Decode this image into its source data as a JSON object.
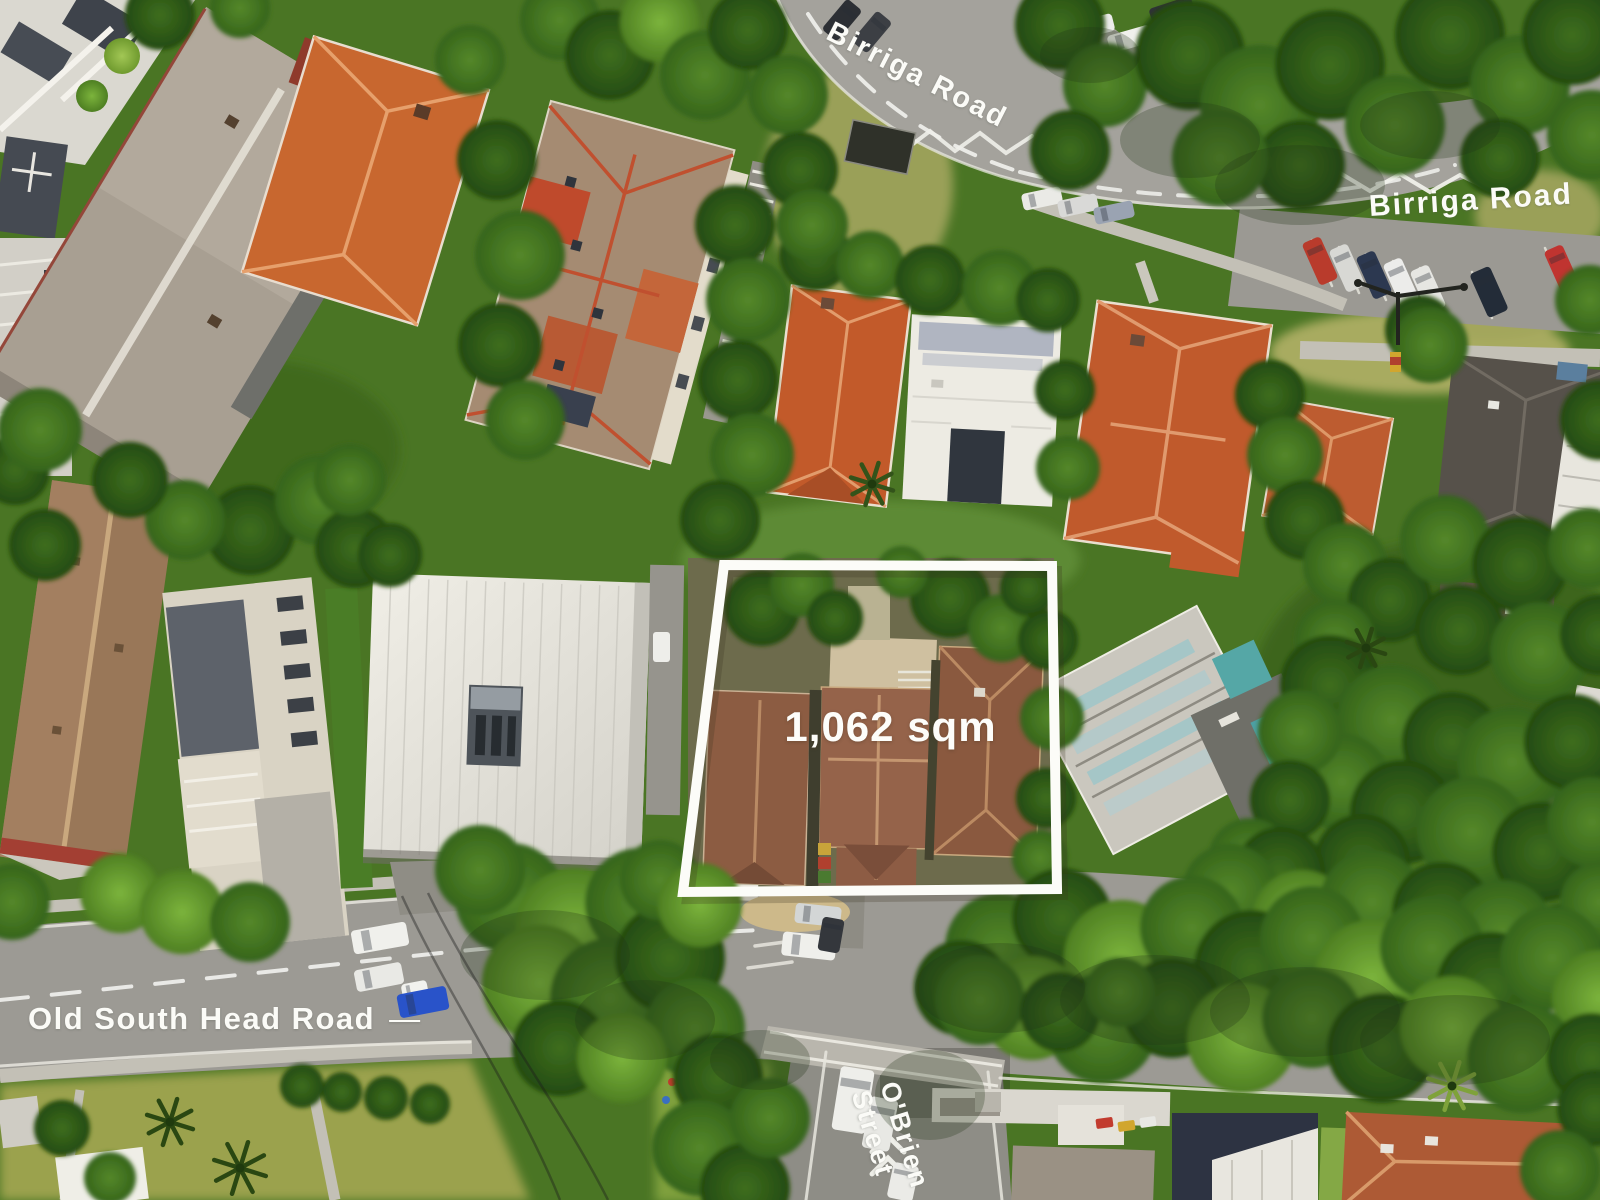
{
  "annotations": {
    "birriga_road_top": {
      "text": "Birriga Road"
    },
    "birriga_road_right": {
      "text": "Birriga Road"
    },
    "lot": {
      "area_label": "1,062 sqm",
      "outline_color": "#fcfcf8"
    },
    "old_south_head_road": {
      "text": "Old South Head Road",
      "dash": "—"
    },
    "obrien_street": {
      "line1": "O'Brien",
      "line2": "Street"
    }
  },
  "palette": {
    "label_text": "#fbfbf7",
    "lot_outline": "#fcfcf8",
    "road": "#a4a29c",
    "road_shaded": "#8e8d86",
    "tree_dark": "#2f5a17",
    "tree_mid": "#4a7c24",
    "tree_bright": "#6fa52f",
    "grass": "#9aa64f",
    "roof_terracotta": "#c45f2f",
    "roof_weathered_brown": "#8f5f46",
    "roof_grey": "#a59482",
    "roof_white": "#e9e7df",
    "roof_navy": "#2d3342",
    "pool_teal": "#55a7a6"
  }
}
